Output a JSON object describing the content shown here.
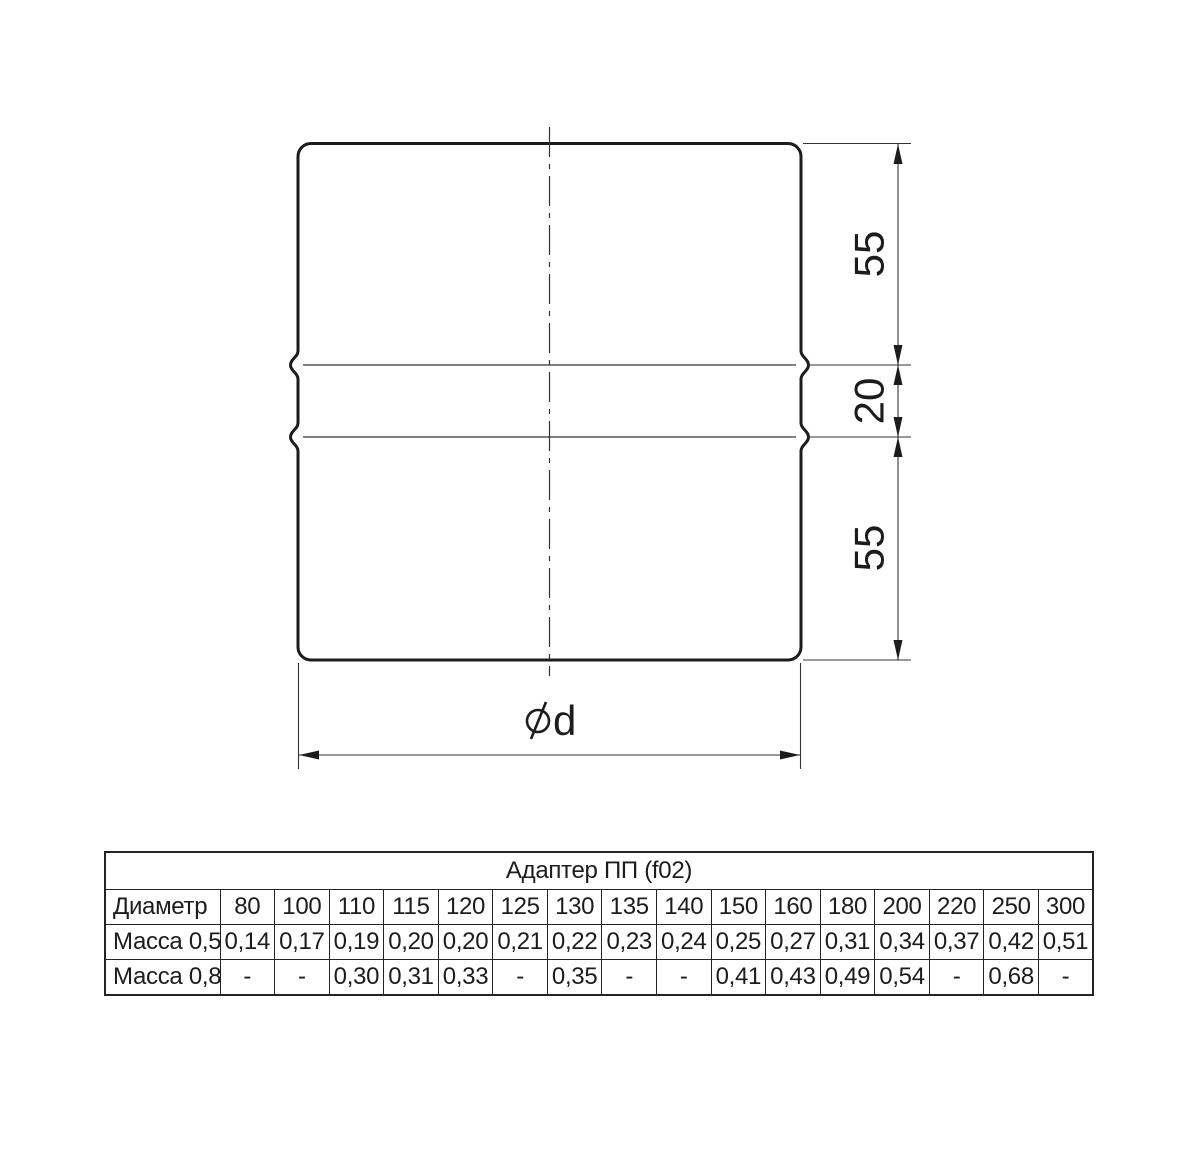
{
  "drawing": {
    "dim_top": "55",
    "dim_middle": "20",
    "dim_bottom": "55",
    "diameter": {
      "symbol": "⌀",
      "label": "d"
    }
  },
  "table": {
    "title": "Адаптер ПП (f02)",
    "rows": [
      {
        "header": "Диаметр",
        "cells": [
          "80",
          "100",
          "110",
          "115",
          "120",
          "125",
          "130",
          "135",
          "140",
          "150",
          "160",
          "180",
          "200",
          "220",
          "250",
          "300"
        ]
      },
      {
        "header": "Масса 0,5",
        "cells": [
          "0,14",
          "0,17",
          "0,19",
          "0,20",
          "0,20",
          "0,21",
          "0,22",
          "0,23",
          "0,24",
          "0,25",
          "0,27",
          "0,31",
          "0,34",
          "0,37",
          "0,42",
          "0,51"
        ]
      },
      {
        "header": "Масса 0,8",
        "cells": [
          "-",
          "-",
          "0,30",
          "0,31",
          "0,33",
          "-",
          "0,35",
          "-",
          "-",
          "0,41",
          "0,43",
          "0,49",
          "0,54",
          "-",
          "0,68",
          "-"
        ]
      }
    ]
  },
  "colors": {
    "outline": "#1c1c1c",
    "thin_line": "#333333",
    "table_border": "#232323",
    "background": "#ffffff"
  }
}
